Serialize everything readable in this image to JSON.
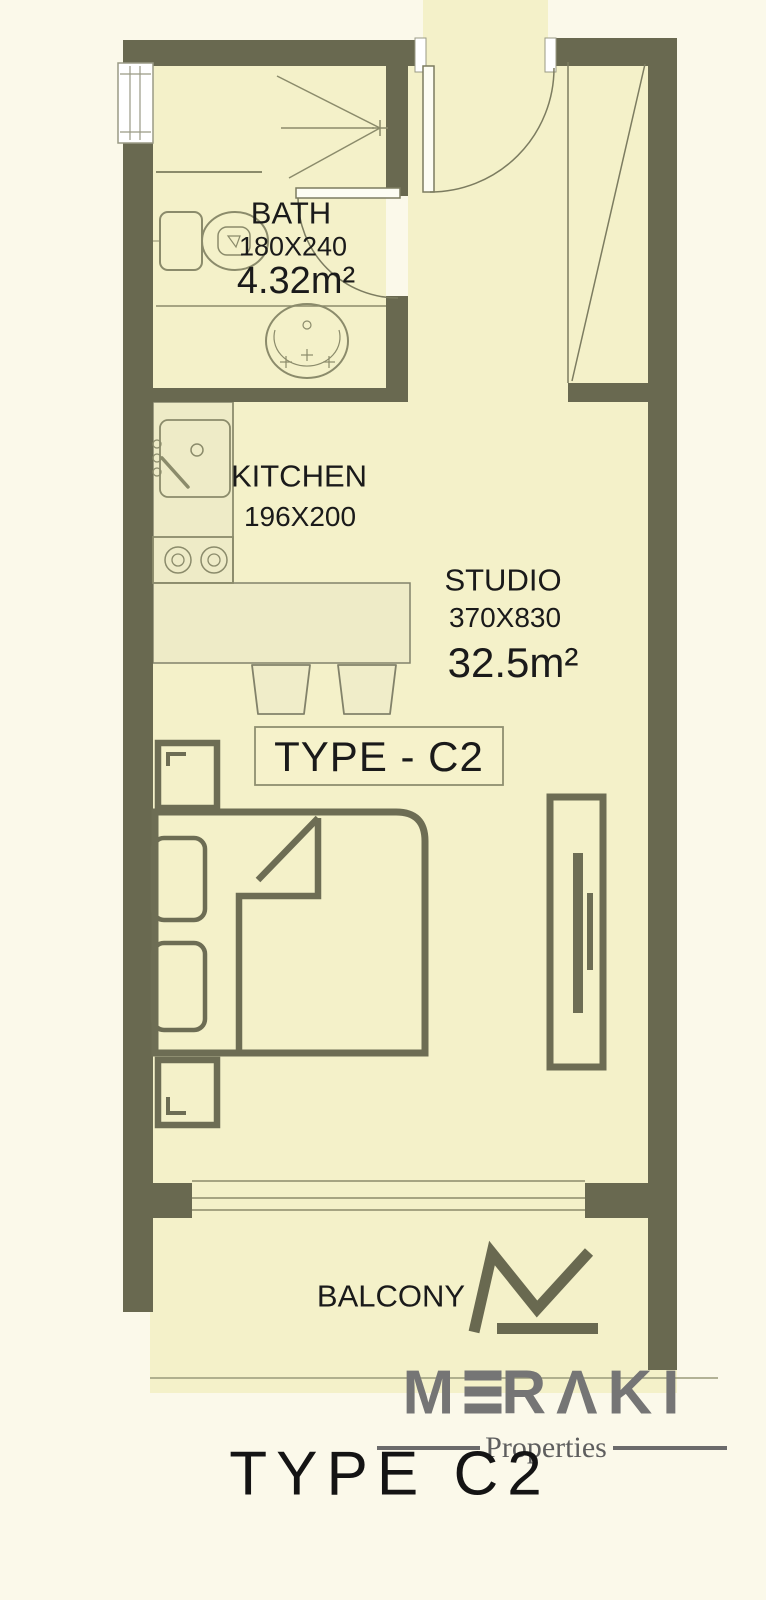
{
  "colors": {
    "background": "#fbf9ea",
    "floor": "#f4f1c9",
    "counter_surface": "#eeebc7",
    "wall": "#696950",
    "fixture_line": "#8b8b6b",
    "furniture_line": "#6d6d54",
    "text": "#1a1a1a",
    "brand_gray": "#757575",
    "logo_olive": "#696950"
  },
  "rooms": {
    "bath": {
      "name": "BATH",
      "dimensions": "180X240",
      "area": "4.32m²"
    },
    "kitchen": {
      "name": "KITCHEN",
      "dimensions": "196X200"
    },
    "studio": {
      "name": "STUDIO",
      "dimensions": "370X830",
      "area": "32.5m²"
    },
    "balcony": {
      "name": "BALCONY"
    }
  },
  "unit_type_box": {
    "label": "TYPE - C2"
  },
  "brand": {
    "name": "MERAKI",
    "subtitle": "Properties"
  },
  "footer": {
    "label": "TYPE C2"
  }
}
